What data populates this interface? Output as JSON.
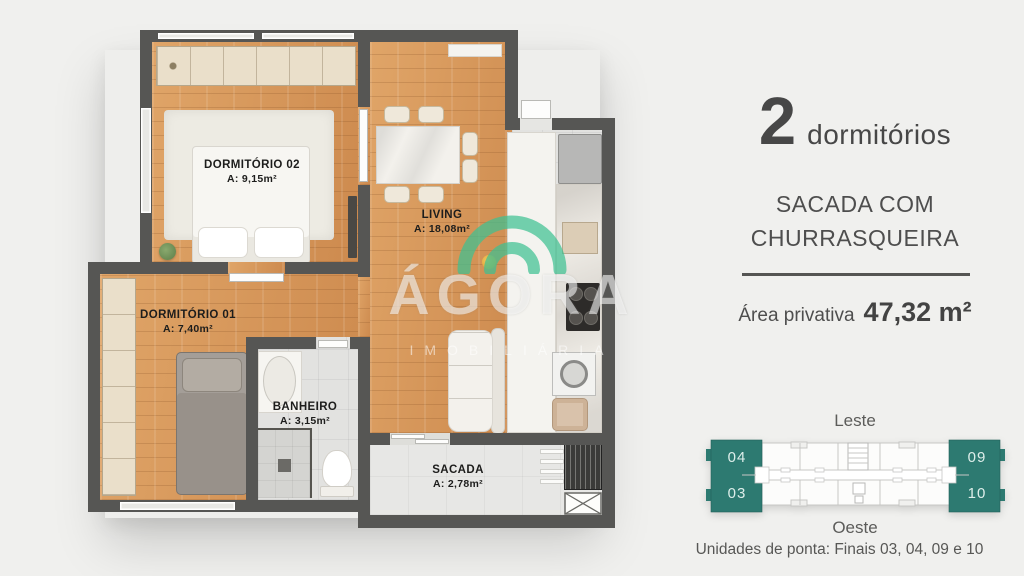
{
  "info_panel": {
    "bedrooms_count": "2",
    "bedrooms_word": "dormitórios",
    "feature_line1": "SACADA COM",
    "feature_line2": "CHURRASQUEIRA",
    "area_label": "Área privativa",
    "area_value": "47,32 m²"
  },
  "floorplan": {
    "rooms": {
      "dorm2": {
        "name": "DORMITÓRIO 02",
        "area": "A: 9,15m²"
      },
      "dorm1": {
        "name": "DORMITÓRIO 01",
        "area": "A: 7,40m²"
      },
      "living": {
        "name": "LIVING",
        "area": "A: 18,08m²"
      },
      "banheiro": {
        "name": "BANHEIRO",
        "area": "A: 3,15m²"
      },
      "sacada": {
        "name": "SACADA",
        "area": "A: 2,78m²"
      }
    },
    "watermark": {
      "brand": "ÁGORA",
      "subtitle": "IMOBILIÁRIA"
    }
  },
  "unit_diagram": {
    "label_east": "Leste",
    "label_west": "Oeste",
    "corner_units": {
      "top_left": "04",
      "bottom_left": "03",
      "top_right": "09",
      "bottom_right": "10"
    },
    "caption": "Unidades de ponta: Finais 03, 04, 09 e 10",
    "highlight_color": "#2d7a71"
  },
  "colors": {
    "background": "#f0f0ee",
    "wall": "#565654",
    "wood_floor": "#d79a60",
    "tile_floor": "#e2e2e0",
    "accent_teal": "#2d7a71",
    "text_dark": "#474747",
    "watermark_green": "#3fc091"
  }
}
